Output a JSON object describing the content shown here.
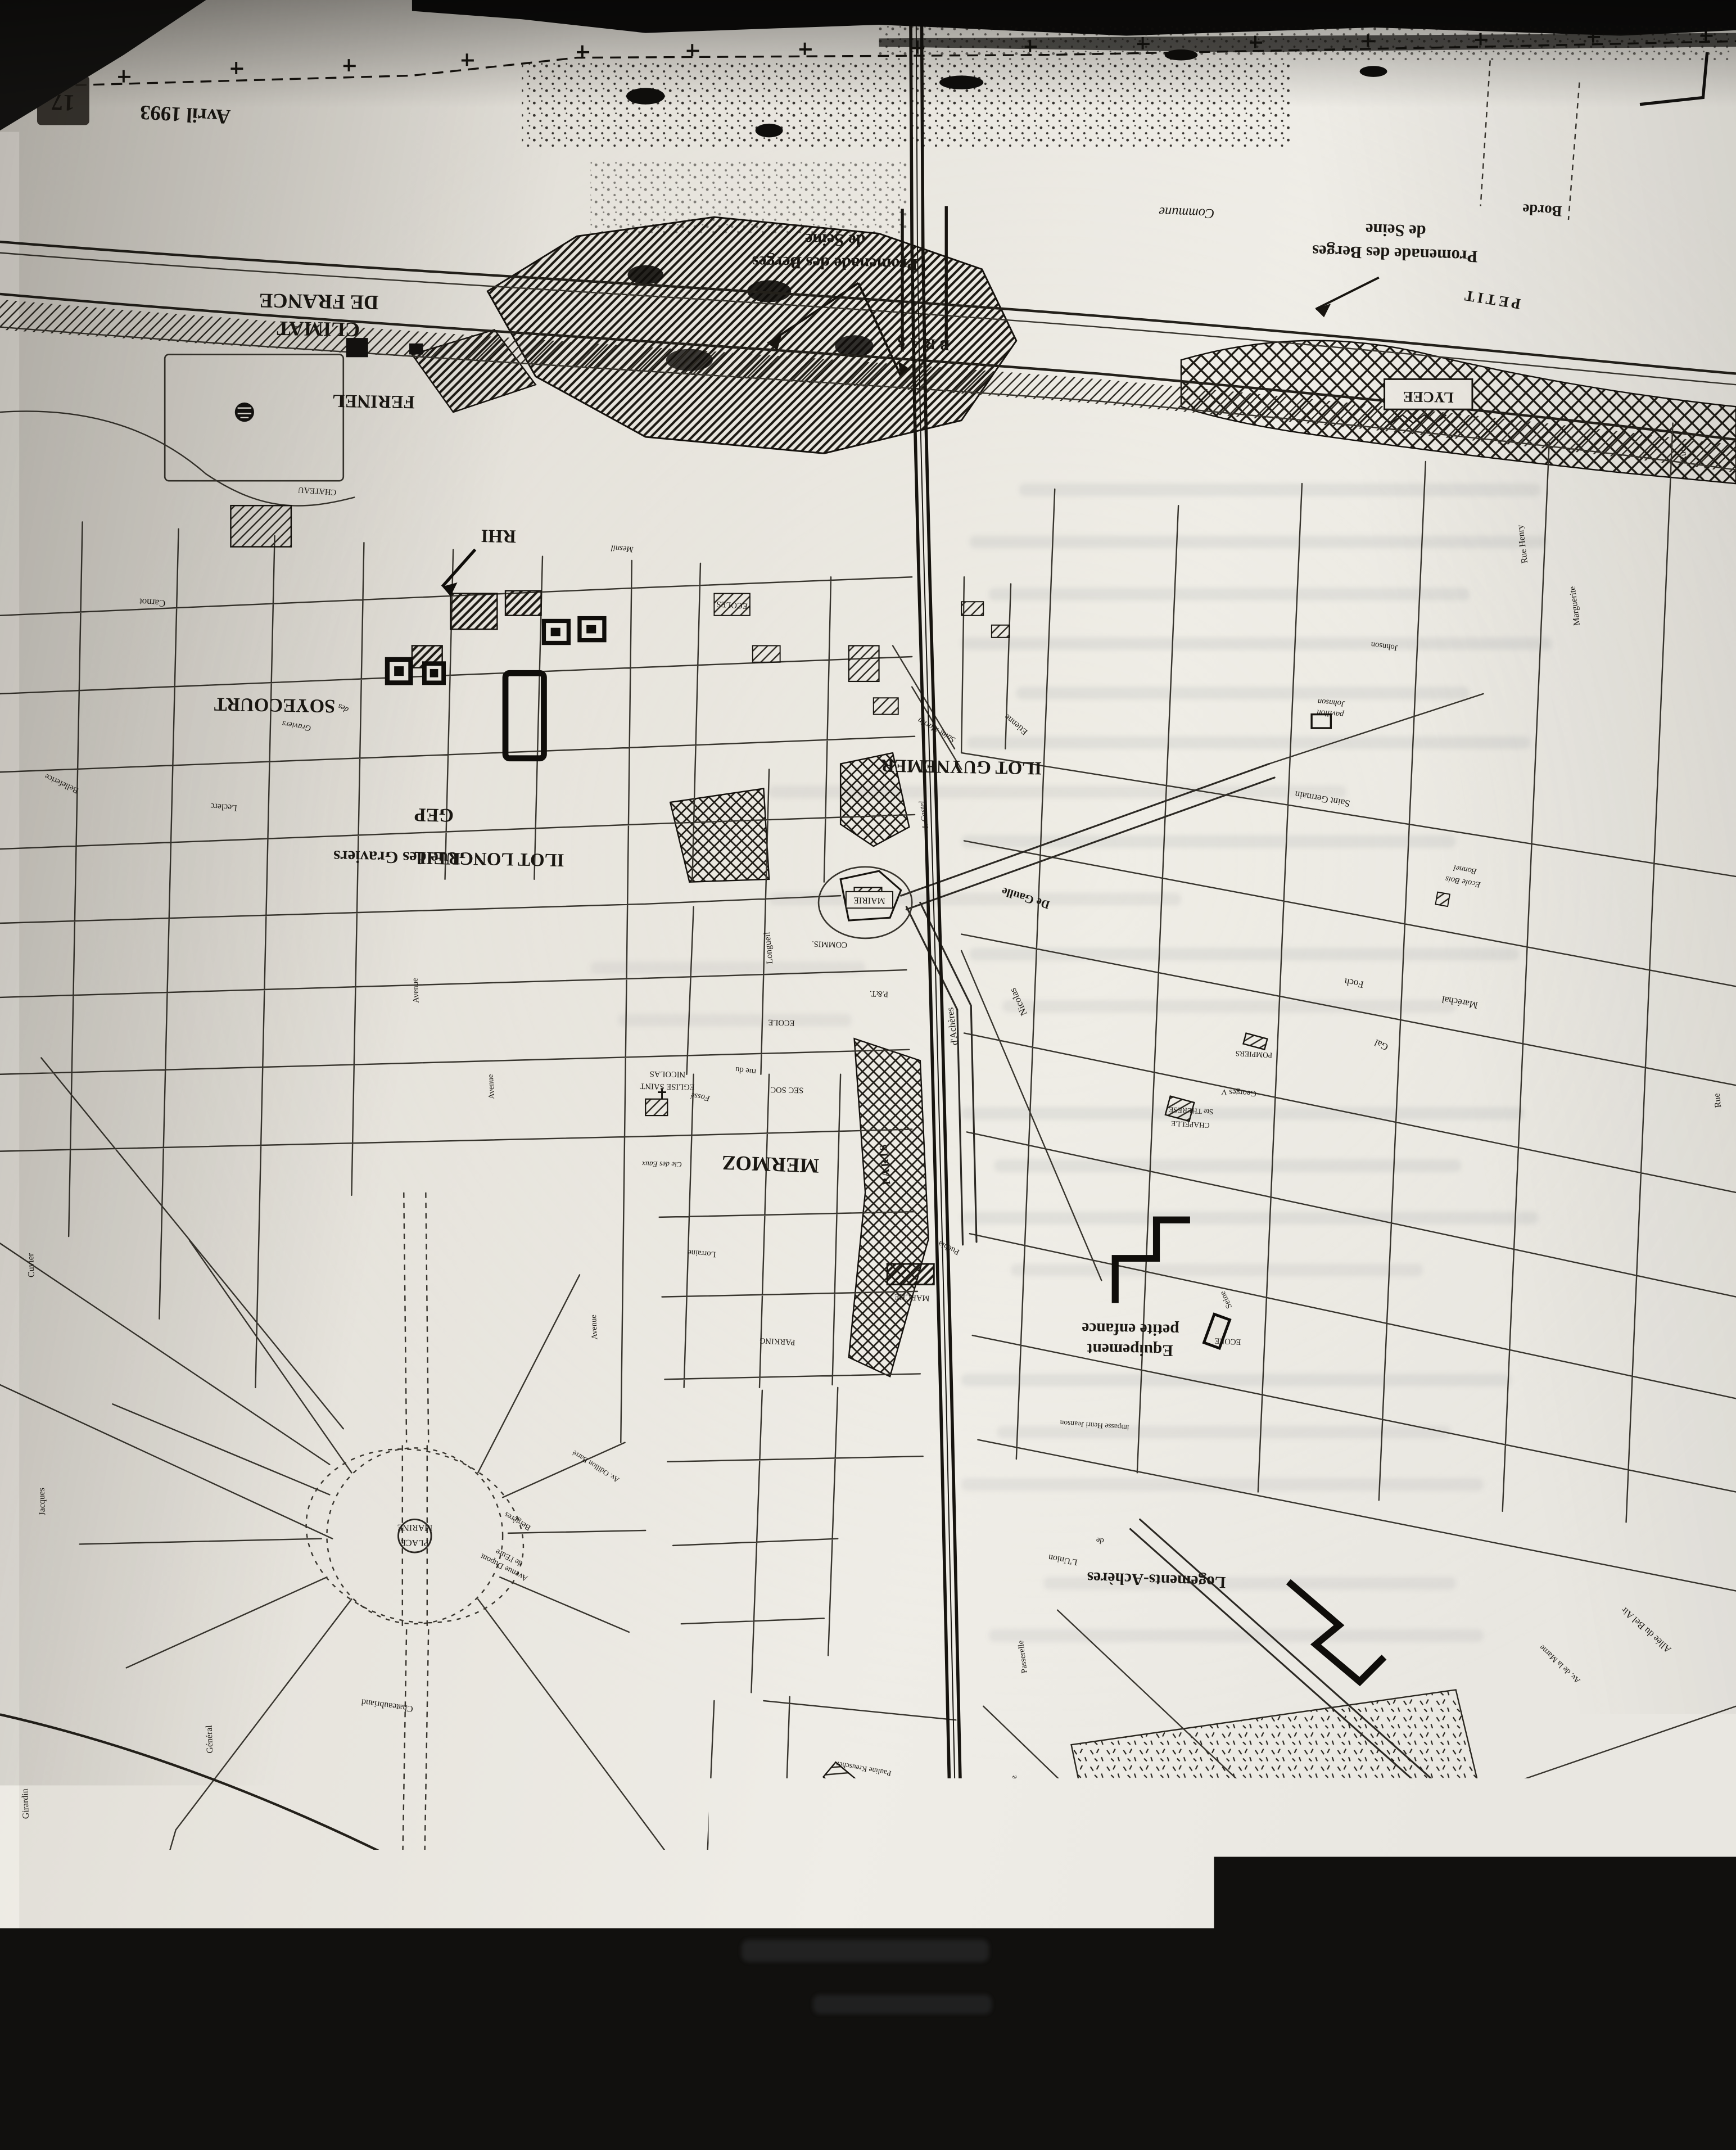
{
  "major": {
    "date": "Avril 1993",
    "page_number": "17",
    "climat_1": "CLIMAT",
    "climat_2": "DE FRANCE",
    "ferinel": "FERINEL",
    "rhi": "RHI",
    "soyecourt": "SOYECOURT",
    "gep": "GEP",
    "rue_des_graviers": "Rue des Graviers",
    "ilot_longueil": "ILOT LONGUEIL",
    "ilot_guynemer": "ILOT GUYNEMER",
    "mermoz": "MERMOZ",
    "promenade_1": "Promenade des Berges",
    "promenade_2": "de Seine",
    "bras": "BRAS",
    "petit": "PETIT",
    "lycee": "LYCEE",
    "borde": "Borde",
    "commune": "Commune",
    "equipement_1": "Equipement",
    "equipement_2": "petite enfance",
    "logements": "Logements-Achères"
  },
  "railway": {
    "paris": "PARIS",
    "havre": "HAVRE"
  },
  "pois": {
    "mairie": "MAIRIE",
    "marche": "MARCHE",
    "parking": "PARKING",
    "commissariat": "COMMIS.",
    "pt": "P.&T.",
    "ecole": "ECOLE",
    "ecoles": "ECOLES",
    "eglise_1": "EGLISE SAINT",
    "eglise_2": "NICOLAS",
    "sec_soc": "SEC SOC",
    "cie_des_eaux": "Cie des Eaux",
    "chapelle_1": "CHAPELLE",
    "chapelle_2": "Ste THERESE",
    "pompiers": "POMPIERS",
    "groupe_1": "GROUPE",
    "groupe_2": "SCOLAIRE",
    "groupe_3": "J. COCTEAU",
    "gymnase": "GYMNASE",
    "piscine": "PISCINE",
    "chateau": "CHATEAU",
    "ecole_bois_1": "Ecole Bois",
    "ecole_bois_2": "Bonnel",
    "pavillon_1": "pavillon",
    "pavillon_2": "Johnson",
    "place_1": "PLACE",
    "place_2": "MARINE"
  },
  "streets": {
    "saint_germain": "Saint Germain",
    "marechal": "Maréchal",
    "foch": "Foch",
    "gal": "Gal",
    "de_gaulle": "De Gaulle",
    "acheres": "d'Achères",
    "nicolas": "Nicolas",
    "saint_martin": "Saint Martin",
    "castel": "I. Castel",
    "etienne": "Etienne",
    "mesnil": "Mesnil",
    "graviers": "Graviers",
    "des": "des",
    "longueil": "Longueil",
    "carnot": "Carnot",
    "chateaubriand": "Chateaubriand",
    "dupont_1": "Avenue Dupont",
    "dupont_2": "de l'Eure",
    "bergeres": "Bergères",
    "odillon": "Av. Odillon Barré",
    "union": "L'Union",
    "de": "de",
    "passerelle": "Passerelle",
    "henri_jeanson": "impasse Henri Jeanson",
    "seine": "Seine",
    "bel_air": "Allée du Bel Air",
    "marne": "Av. de la Marne",
    "henry": "Rue Henry",
    "marguerite": "Marguerite",
    "johnson": "Johnson",
    "lorraine": "Lorraine",
    "puebla": "Puebla",
    "fosse": "Fossé",
    "rue_du": "rue du",
    "rue": "Rue",
    "avenue": "Avenue",
    "platanes": "des Platanes",
    "leclerc": "Leclerc",
    "cuvier": "Cuvier",
    "jacques": "Jacques",
    "girardin": "Girardin",
    "cardinal": "Cardinal",
    "voltaire": "Voltaire",
    "general": "Général",
    "belleferice": "Belleferice",
    "pauline": "Pauline Kreuscher",
    "georges": "Georges V"
  },
  "colors": {
    "paper": "#e9e6df",
    "ink": "#17140f",
    "photo_edge": "#0d0c0b"
  }
}
